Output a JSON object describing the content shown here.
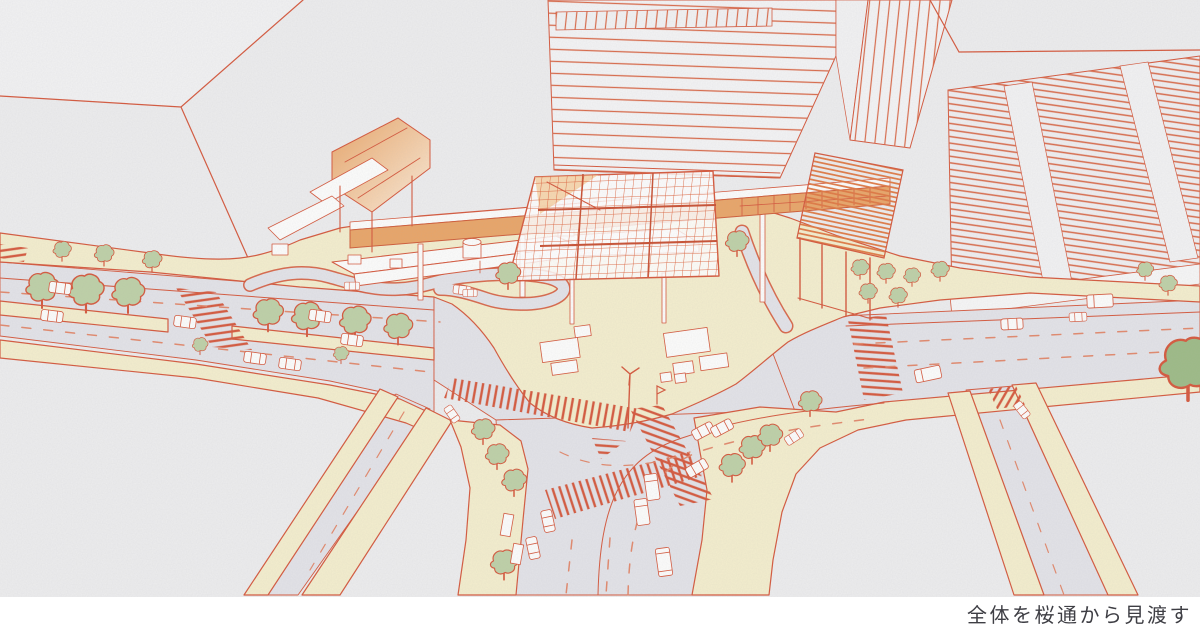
{
  "caption": {
    "text": "全体を桜通から見渡す"
  },
  "palette": {
    "canvas": "#ffffff",
    "paper": "#ededee",
    "paper_light": "#f2f2f3",
    "building_fill": "#f4f4f5",
    "road": "#e3e3e8",
    "cream": "#f4eecd",
    "ink_red": "#d5563a",
    "ink_red_soft": "#e2876a",
    "orange_deck": "#e9a466",
    "orange_light": "#f5c994",
    "orange_pale": "#fcecd8",
    "tree_green": "#bdd0a6",
    "tree_dark": "#9cba85",
    "white": "#fdfdfc",
    "caption_ink": "#3e3e44"
  },
  "illustration": {
    "alt": "Hand-drawn aerial illustration of a station-front plaza: an orange grid canopy and elevated pedestrian deck over a cream plaza, surrounded by office towers, a tree-lined avenue, a large crossing with red hatched crosswalks, buses, cars and street trees."
  }
}
